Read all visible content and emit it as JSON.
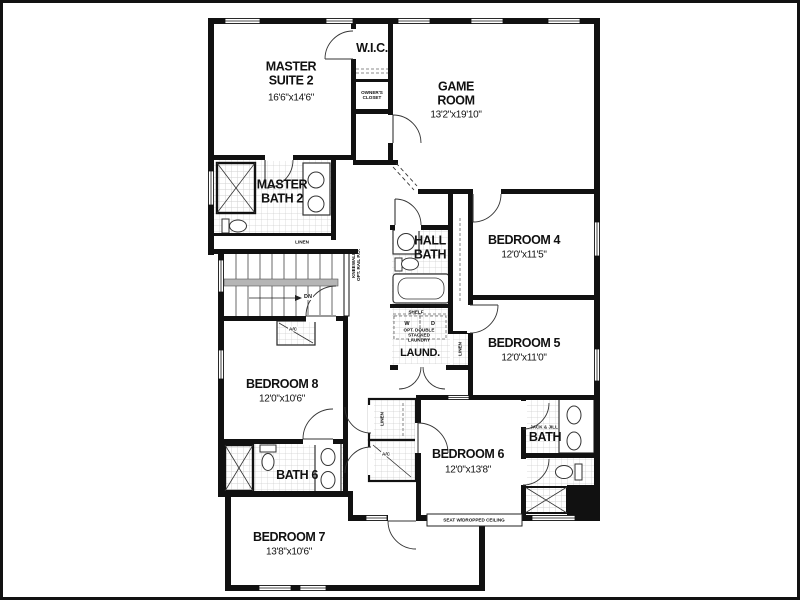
{
  "colors": {
    "wall": "#111111",
    "tile_line": "#cfcfcf",
    "background": "#ffffff",
    "rail_fill": "#b5b5b5"
  },
  "rooms": {
    "master_suite_2": {
      "label": "MASTER SUITE 2",
      "dims": "16'6\"x14'6\""
    },
    "wic": {
      "label": "W.I.C."
    },
    "owners_closet": {
      "label": "OWNER'S CLOSET"
    },
    "game_room": {
      "label": "GAME ROOM",
      "dims": "13'2\"x19'10\""
    },
    "master_bath_2": {
      "label": "MASTER BATH 2"
    },
    "linen_1": {
      "label": "LINEN"
    },
    "stairs": {
      "label": "DN",
      "note_line1": "KNEEWALL",
      "note_line2": "OPT. RAIL P.O."
    },
    "hall_bath": {
      "label": "HALL BATH"
    },
    "bedroom_4": {
      "label": "BEDROOM 4",
      "dims": "12'0\"x11'5\""
    },
    "bedroom_5": {
      "label": "BEDROOM 5",
      "dims": "12'0\"x11'0\""
    },
    "laundry": {
      "label": "LAUND.",
      "shelf": "SHELF",
      "washer": "W",
      "dryer": "D",
      "note": "OPT. DOUBLE STACKED LAUNDRY"
    },
    "linen_2": {
      "label": "LINEN"
    },
    "bedroom_8": {
      "label": "BEDROOM 8",
      "dims": "12'0\"x10'6\""
    },
    "ac_closet_1": {
      "label": "A/C"
    },
    "bath_6": {
      "label": "BATH 6"
    },
    "linen_3": {
      "label": "LINEN"
    },
    "ac_closet_2": {
      "label": "A/C"
    },
    "bedroom_6": {
      "label": "BEDROOM 6",
      "dims": "12'0\"x13'8\"",
      "note": "SEAT W/DROPPED CEILING"
    },
    "jack_jill_bath": {
      "label_small": "JACK & JILL",
      "label": "BATH"
    },
    "bedroom_7": {
      "label": "BEDROOM 7",
      "dims": "13'8\"x10'6\""
    }
  }
}
